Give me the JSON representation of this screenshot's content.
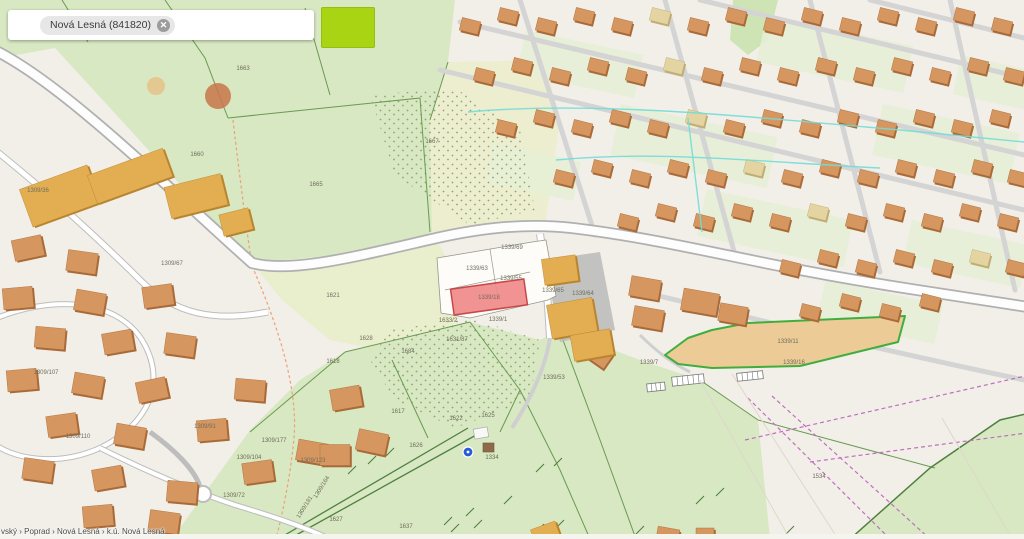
{
  "search": {
    "chip_label": "Nová Lesná (841820)",
    "clear_icon": "✕"
  },
  "toolbar": {
    "swatch_color": "#a8d414"
  },
  "breadcrumb": {
    "path": "vský › Poprad › Nová Lesná › k.ú. Nová Lesná"
  },
  "map": {
    "selected_parcel": {
      "label": "1339/18",
      "fill": "#f28b8b",
      "border": "#c23a3a"
    },
    "highlighted_parcel": {
      "label": "1339/11",
      "fill": "#edcb97",
      "border": "#3fae3f"
    },
    "colors": {
      "field_green": "#d8e8c2",
      "scrub_yellow": "#e9eecd",
      "building_orange": "#d6965f",
      "building_yellow": "#e9c878",
      "road_fill": "#fdfdfd",
      "road_casing": "#b0b0b0",
      "utility_cyan": "#74dcd8",
      "utility_magenta": "#c06ec0",
      "boundary_green": "#5c8a4a",
      "swatch_lime": "#a8d414"
    },
    "labels": [
      {
        "t": "1309/36",
        "x": 38,
        "y": 192
      },
      {
        "t": "1309/67",
        "x": 172,
        "y": 265
      },
      {
        "t": "1660",
        "x": 197,
        "y": 156
      },
      {
        "t": "1663",
        "x": 243,
        "y": 70
      },
      {
        "t": "1665",
        "x": 316,
        "y": 186
      },
      {
        "t": "1667",
        "x": 432,
        "y": 143
      },
      {
        "t": "1621",
        "x": 333,
        "y": 297
      },
      {
        "t": "1618",
        "x": 333,
        "y": 363
      },
      {
        "t": "1628",
        "x": 366,
        "y": 340
      },
      {
        "t": "1684",
        "x": 408,
        "y": 353
      },
      {
        "t": "1617",
        "x": 398,
        "y": 413
      },
      {
        "t": "1622",
        "x": 456,
        "y": 420
      },
      {
        "t": "1625",
        "x": 488,
        "y": 417
      },
      {
        "t": "1626",
        "x": 416,
        "y": 447
      },
      {
        "t": "1627",
        "x": 336,
        "y": 521
      },
      {
        "t": "1637",
        "x": 406,
        "y": 528
      },
      {
        "t": "1334",
        "x": 492,
        "y": 459
      },
      {
        "t": "1534",
        "x": 819,
        "y": 478
      },
      {
        "t": "1309/107",
        "x": 46,
        "y": 374
      },
      {
        "t": "1309/110",
        "x": 78,
        "y": 438
      },
      {
        "t": "1309/91",
        "x": 205,
        "y": 428
      },
      {
        "t": "1309/177",
        "x": 274,
        "y": 442
      },
      {
        "t": "1309/104",
        "x": 249,
        "y": 459
      },
      {
        "t": "1309/123",
        "x": 313,
        "y": 462
      },
      {
        "t": "1309/72",
        "x": 234,
        "y": 497
      },
      {
        "t": "1309/164",
        "x": 323,
        "y": 488,
        "r": -58
      },
      {
        "t": "1309/181",
        "x": 306,
        "y": 508,
        "r": -58
      },
      {
        "t": "1631/87",
        "x": 457,
        "y": 341
      },
      {
        "t": "1633/2",
        "x": 448,
        "y": 322
      },
      {
        "t": "1339/63",
        "x": 477,
        "y": 270
      },
      {
        "t": "1339/55",
        "x": 511,
        "y": 280
      },
      {
        "t": "1339/69",
        "x": 512,
        "y": 249
      },
      {
        "t": "1339/65",
        "x": 553,
        "y": 292
      },
      {
        "t": "1339/64",
        "x": 583,
        "y": 295
      },
      {
        "t": "1339/1",
        "x": 498,
        "y": 321
      },
      {
        "t": "1339/53",
        "x": 554,
        "y": 379
      },
      {
        "t": "1339/7",
        "x": 649,
        "y": 364
      },
      {
        "t": "1339/16",
        "x": 794,
        "y": 364
      }
    ]
  }
}
